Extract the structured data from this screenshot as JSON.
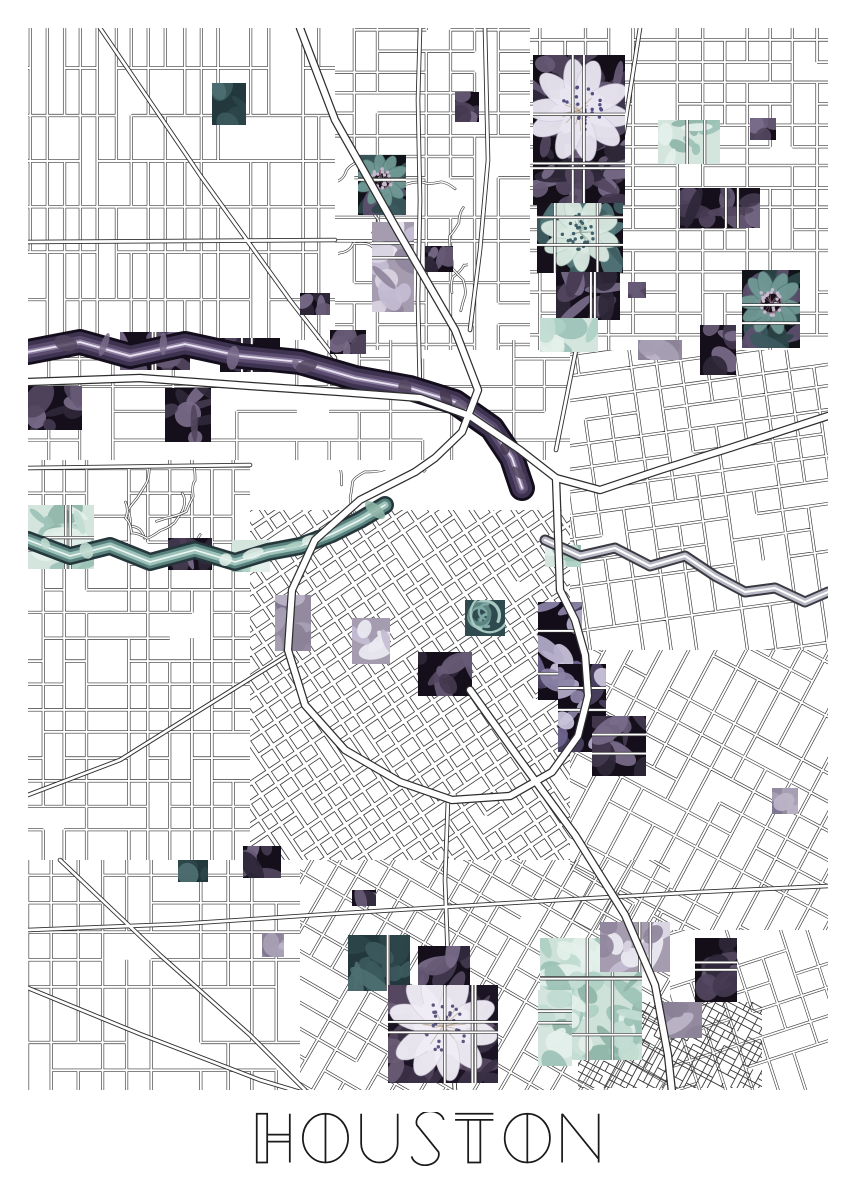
{
  "poster": {
    "title": "HOUSTON",
    "title_color": "#1a1a1a",
    "background": "#ffffff"
  },
  "map": {
    "region": {
      "x": 28,
      "y": 28,
      "w": 800,
      "h": 1062
    },
    "line_color": "#3a3a3a",
    "street_fill": "#ffffff",
    "palette": {
      "dark_base": "#130e18",
      "purple_leaf": [
        "#52465f",
        "#675a76",
        "#443a50",
        "#786b8a",
        "#2e2738"
      ],
      "lavender": [
        "#b4aecb",
        "#cdc7de",
        "#8d84a8",
        "#6f6590",
        "#4a4160"
      ],
      "petal_light": "#e8e5f0",
      "petal_shade": "#c8c2da",
      "stamen_dot": "#514e80",
      "stamen_line": "#ab9578",
      "mint": [
        "#c2dcd2",
        "#aed0c4",
        "#e4f0ea",
        "#9cc2b6",
        "#8fb5a8"
      ],
      "dark_teal": [
        "#3c5a5e",
        "#2c4549",
        "#4e6f72",
        "#16282b"
      ],
      "mauve": [
        "#a79fb4",
        "#8b8298",
        "#bcb5c8",
        "#7d7490"
      ],
      "bayou_purple": [
        "#140e1c",
        "#3d3350",
        "#5a4c6e",
        "#8d80a2",
        "#e8e4f0"
      ],
      "bayou_teal": [
        "#24363a",
        "#58807c",
        "#9cc2ba",
        "#f0f6f3"
      ],
      "bayou_gray": [
        "#3a3a42",
        "#b9b9c6",
        "#ffffff"
      ]
    },
    "districts": [
      {
        "x": 28,
        "y": 28,
        "w": 307,
        "h": 312,
        "angle": 0,
        "sx": 17,
        "sy": 46,
        "skip": 0.1,
        "lw": 3.2,
        "sw": 1.9
      },
      {
        "x": 335,
        "y": 28,
        "w": 195,
        "h": 322,
        "angle": 0,
        "sx": 24,
        "sy": 21,
        "skip": 0.16,
        "lw": 3.2,
        "sw": 1.9
      },
      {
        "x": 530,
        "y": 28,
        "w": 298,
        "h": 322,
        "angle": 0,
        "sx": 23,
        "sy": 21,
        "skip": 0.13,
        "lw": 3.2,
        "sw": 1.9
      },
      {
        "x": 28,
        "y": 340,
        "w": 542,
        "h": 120,
        "angle": 0,
        "sx": 31,
        "sy": 27,
        "skip": 0.28,
        "lw": 3.0,
        "sw": 1.8
      },
      {
        "x": 570,
        "y": 350,
        "w": 258,
        "h": 300,
        "angle": -8,
        "sx": 26,
        "sy": 23,
        "skip": 0.13,
        "lw": 3.2,
        "sw": 1.9
      },
      {
        "x": 28,
        "y": 460,
        "w": 222,
        "h": 400,
        "angle": 0,
        "sx": 21,
        "sy": 24,
        "skip": 0.13,
        "lw": 3.2,
        "sw": 1.9
      },
      {
        "x": 250,
        "y": 510,
        "w": 320,
        "h": 350,
        "angle": -34,
        "sx": 17.5,
        "sy": 17.5,
        "skip": 0.05,
        "lw": 5.0,
        "sw": 3.4
      },
      {
        "x": 570,
        "y": 650,
        "w": 258,
        "h": 280,
        "angle": 28,
        "sx": 25,
        "sy": 25,
        "skip": 0.13,
        "lw": 3.2,
        "sw": 1.9
      },
      {
        "x": 28,
        "y": 860,
        "w": 272,
        "h": 230,
        "angle": 0,
        "sx": 25,
        "sy": 28,
        "skip": 0.13,
        "lw": 3.2,
        "sw": 1.9
      },
      {
        "x": 300,
        "y": 860,
        "w": 370,
        "h": 230,
        "angle": 30,
        "sx": 23,
        "sy": 23,
        "skip": 0.13,
        "lw": 3.2,
        "sw": 1.9
      },
      {
        "x": 670,
        "y": 930,
        "w": 158,
        "h": 160,
        "angle": -18,
        "sx": 25,
        "sy": 25,
        "skip": 0.16,
        "lw": 3.0,
        "sw": 1.8
      },
      {
        "x": 578,
        "y": 1002,
        "w": 184,
        "h": 86,
        "angle": 28,
        "sx": 6.5,
        "sy": 6.5,
        "skip": 0.15,
        "lw": 0.9,
        "sw": 0
      }
    ],
    "squiggles": [
      {
        "x": 338,
        "y": 155,
        "w": 130,
        "h": 175,
        "n": 7
      },
      {
        "x": 118,
        "y": 465,
        "w": 95,
        "h": 75,
        "n": 4
      },
      {
        "x": 330,
        "y": 470,
        "w": 120,
        "h": 60,
        "n": 3
      }
    ],
    "roads": [
      [
        [
          640,
          28
        ],
        [
          624,
          130
        ],
        [
          600,
          240
        ],
        [
          580,
          330
        ],
        [
          566,
          400
        ],
        [
          556,
          450
        ]
      ],
      [
        [
          485,
          28
        ],
        [
          488,
          160
        ],
        [
          480,
          250
        ],
        [
          470,
          330
        ]
      ],
      [
        [
          100,
          28
        ],
        [
          200,
          175
        ],
        [
          290,
          300
        ],
        [
          335,
          358
        ]
      ],
      [
        [
          420,
          392
        ],
        [
          418,
          300
        ],
        [
          420,
          200
        ],
        [
          418,
          100
        ],
        [
          420,
          28
        ]
      ],
      [
        [
          28,
          242
        ],
        [
          335,
          240
        ]
      ],
      [
        [
          28,
          468
        ],
        [
          250,
          465
        ]
      ],
      [
        [
          28,
          930
        ],
        [
          180,
          924
        ],
        [
          330,
          914
        ],
        [
          560,
          900
        ],
        [
          700,
          892
        ],
        [
          828,
          886
        ]
      ],
      [
        [
          28,
          988
        ],
        [
          140,
          1034
        ],
        [
          260,
          1080
        ],
        [
          300,
          1092
        ]
      ],
      [
        [
          60,
          860
        ],
        [
          160,
          955
        ],
        [
          250,
          1035
        ],
        [
          305,
          1090
        ]
      ],
      [
        [
          288,
          655
        ],
        [
          200,
          710
        ],
        [
          120,
          760
        ],
        [
          28,
          795
        ]
      ],
      [
        [
          448,
          800
        ],
        [
          445,
          880
        ],
        [
          448,
          960
        ],
        [
          452,
          1040
        ],
        [
          455,
          1092
        ]
      ]
    ],
    "highways": [
      [
        [
          300,
          28
        ],
        [
          335,
          120
        ],
        [
          400,
          235
        ],
        [
          455,
          330
        ],
        [
          478,
          390
        ],
        [
          462,
          432
        ],
        [
          435,
          458
        ],
        [
          415,
          472
        ]
      ],
      [
        [
          28,
          382
        ],
        [
          140,
          378
        ],
        [
          250,
          386
        ],
        [
          340,
          392
        ],
        [
          420,
          398
        ],
        [
          470,
          416
        ],
        [
          520,
          450
        ],
        [
          556,
          478
        ],
        [
          600,
          490
        ],
        [
          660,
          470
        ],
        [
          730,
          448
        ],
        [
          828,
          416
        ]
      ],
      [
        [
          415,
          472
        ],
        [
          360,
          500
        ],
        [
          315,
          540
        ],
        [
          292,
          590
        ],
        [
          288,
          650
        ],
        [
          305,
          705
        ],
        [
          345,
          750
        ],
        [
          400,
          782
        ],
        [
          452,
          800
        ],
        [
          510,
          796
        ],
        [
          552,
          772
        ],
        [
          578,
          736
        ],
        [
          588,
          696
        ],
        [
          585,
          655
        ],
        [
          575,
          620
        ],
        [
          560,
          590
        ],
        [
          556,
          478
        ]
      ],
      [
        [
          470,
          690
        ],
        [
          520,
          760
        ],
        [
          575,
          835
        ],
        [
          625,
          915
        ],
        [
          655,
          985
        ],
        [
          668,
          1055
        ],
        [
          672,
          1092
        ]
      ]
    ],
    "waterways": [
      {
        "name": "bayou-upper-purple",
        "style": "purple",
        "width": 26,
        "pts": [
          [
            28,
            352
          ],
          [
            80,
            342
          ],
          [
            130,
            356
          ],
          [
            185,
            344
          ],
          [
            240,
            356
          ],
          [
            300,
            362
          ],
          [
            355,
            378
          ],
          [
            410,
            388
          ],
          [
            455,
            402
          ],
          [
            492,
            428
          ],
          [
            512,
            458
          ],
          [
            522,
            488
          ]
        ]
      },
      {
        "name": "bayou-west-teal",
        "style": "teal",
        "width": 18,
        "pts": [
          [
            28,
            540
          ],
          [
            70,
            556
          ],
          [
            110,
            546
          ],
          [
            150,
            562
          ],
          [
            195,
            550
          ],
          [
            235,
            562
          ],
          [
            268,
            552
          ],
          [
            300,
            546
          ],
          [
            332,
            534
          ],
          [
            360,
            520
          ],
          [
            385,
            505
          ]
        ]
      },
      {
        "name": "bayou-east-gray",
        "style": "gray",
        "width": 11,
        "pts": [
          [
            545,
            540
          ],
          [
            580,
            556
          ],
          [
            615,
            548
          ],
          [
            650,
            566
          ],
          [
            685,
            556
          ],
          [
            715,
            576
          ],
          [
            745,
            592
          ],
          [
            775,
            588
          ],
          [
            805,
            602
          ],
          [
            828,
            592
          ]
        ]
      }
    ],
    "patches": [
      {
        "x": 212,
        "y": 83,
        "w": 34,
        "h": 42,
        "t": "darkteal"
      },
      {
        "x": 455,
        "y": 92,
        "w": 24,
        "h": 30,
        "t": "dark"
      },
      {
        "x": 533,
        "y": 55,
        "w": 92,
        "h": 150,
        "t": "lavflower"
      },
      {
        "x": 537,
        "y": 203,
        "w": 86,
        "h": 70,
        "t": "mintflower"
      },
      {
        "x": 556,
        "y": 272,
        "w": 64,
        "h": 48,
        "t": "darkpurp"
      },
      {
        "x": 540,
        "y": 318,
        "w": 58,
        "h": 34,
        "t": "mint"
      },
      {
        "x": 658,
        "y": 120,
        "w": 62,
        "h": 44,
        "t": "mint"
      },
      {
        "x": 680,
        "y": 188,
        "w": 80,
        "h": 40,
        "t": "darkpurp"
      },
      {
        "x": 742,
        "y": 270,
        "w": 58,
        "h": 78,
        "t": "tealflower"
      },
      {
        "x": 750,
        "y": 118,
        "w": 26,
        "h": 22,
        "t": "dark"
      },
      {
        "x": 628,
        "y": 282,
        "w": 18,
        "h": 16,
        "t": "dark"
      },
      {
        "x": 638,
        "y": 340,
        "w": 44,
        "h": 20,
        "t": "mauve"
      },
      {
        "x": 358,
        "y": 155,
        "w": 48,
        "h": 60,
        "t": "tealflower"
      },
      {
        "x": 372,
        "y": 222,
        "w": 42,
        "h": 90,
        "t": "mauvewhite"
      },
      {
        "x": 300,
        "y": 293,
        "w": 30,
        "h": 22,
        "t": "dark"
      },
      {
        "x": 330,
        "y": 330,
        "w": 36,
        "h": 24,
        "t": "dark"
      },
      {
        "x": 425,
        "y": 246,
        "w": 28,
        "h": 26,
        "t": "dark"
      },
      {
        "x": 120,
        "y": 332,
        "w": 70,
        "h": 38,
        "t": "darkpurp"
      },
      {
        "x": 220,
        "y": 338,
        "w": 60,
        "h": 34,
        "t": "darkpurp"
      },
      {
        "x": 165,
        "y": 388,
        "w": 46,
        "h": 54,
        "t": "darkpurp"
      },
      {
        "x": 28,
        "y": 386,
        "w": 54,
        "h": 44,
        "t": "darkpurp"
      },
      {
        "x": 28,
        "y": 505,
        "w": 66,
        "h": 64,
        "t": "mint"
      },
      {
        "x": 232,
        "y": 540,
        "w": 38,
        "h": 32,
        "t": "mint"
      },
      {
        "x": 168,
        "y": 538,
        "w": 44,
        "h": 32,
        "t": "darkpurp"
      },
      {
        "x": 275,
        "y": 595,
        "w": 36,
        "h": 56,
        "t": "mauve"
      },
      {
        "x": 352,
        "y": 618,
        "w": 38,
        "h": 46,
        "t": "mauvewhite"
      },
      {
        "x": 418,
        "y": 652,
        "w": 54,
        "h": 44,
        "t": "darkpurp"
      },
      {
        "x": 465,
        "y": 600,
        "w": 40,
        "h": 36,
        "t": "tealswirl"
      },
      {
        "x": 538,
        "y": 602,
        "w": 44,
        "h": 98,
        "t": "lavleaf"
      },
      {
        "x": 558,
        "y": 664,
        "w": 48,
        "h": 88,
        "t": "lavleaf"
      },
      {
        "x": 592,
        "y": 716,
        "w": 54,
        "h": 60,
        "t": "darkpurp"
      },
      {
        "x": 700,
        "y": 325,
        "w": 36,
        "h": 50,
        "t": "darkpurp"
      },
      {
        "x": 545,
        "y": 545,
        "w": 36,
        "h": 22,
        "t": "mint"
      },
      {
        "x": 772,
        "y": 788,
        "w": 26,
        "h": 26,
        "t": "mauve"
      },
      {
        "x": 348,
        "y": 935,
        "w": 62,
        "h": 56,
        "t": "darkteal"
      },
      {
        "x": 418,
        "y": 946,
        "w": 52,
        "h": 50,
        "t": "darkpurp"
      },
      {
        "x": 388,
        "y": 985,
        "w": 110,
        "h": 98,
        "t": "whiteflower"
      },
      {
        "x": 540,
        "y": 938,
        "w": 102,
        "h": 122,
        "t": "mintbig"
      },
      {
        "x": 600,
        "y": 922,
        "w": 70,
        "h": 50,
        "t": "mauvewhite"
      },
      {
        "x": 695,
        "y": 938,
        "w": 42,
        "h": 64,
        "t": "dark"
      },
      {
        "x": 660,
        "y": 1002,
        "w": 42,
        "h": 36,
        "t": "mauve"
      },
      {
        "x": 538,
        "y": 990,
        "w": 34,
        "h": 76,
        "t": "mint"
      },
      {
        "x": 178,
        "y": 860,
        "w": 30,
        "h": 22,
        "t": "darkteal"
      },
      {
        "x": 243,
        "y": 846,
        "w": 38,
        "h": 32,
        "t": "darkpurp"
      },
      {
        "x": 262,
        "y": 933,
        "w": 22,
        "h": 24,
        "t": "mauve"
      },
      {
        "x": 352,
        "y": 890,
        "w": 24,
        "h": 16,
        "t": "darkpurp"
      }
    ]
  }
}
